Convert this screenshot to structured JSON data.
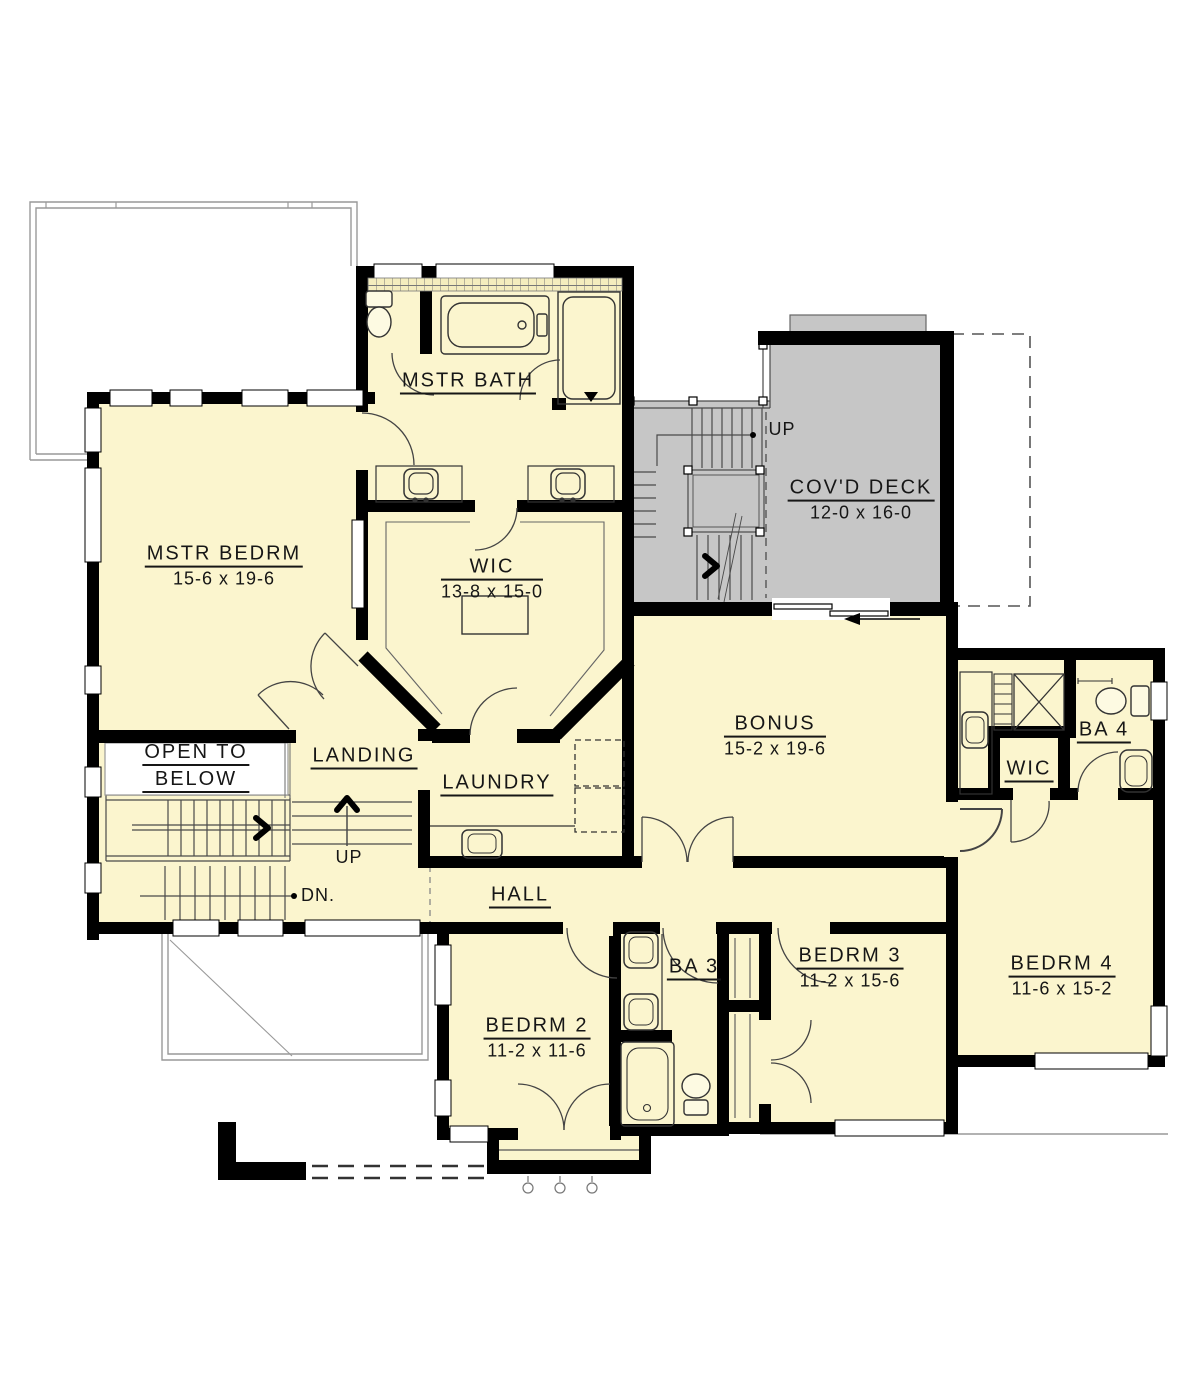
{
  "colors": {
    "floor": "#FBF5CE",
    "deck": "#C6C6C6",
    "wall": "#000000",
    "line": "#4a4a4a"
  },
  "labels": {
    "mstr_bath": {
      "name": "MSTR BATH"
    },
    "mstr_bedrm": {
      "name": "MSTR BEDRM",
      "dims": "15-6 x 19-6"
    },
    "wic_master": {
      "name": "WIC",
      "dims": "13-8 x 15-0"
    },
    "covd_deck": {
      "name": "COV'D DECK",
      "dims": "12-0 x 16-0"
    },
    "bonus": {
      "name": "BONUS",
      "dims": "15-2 x 19-6"
    },
    "ba4": {
      "name": "BA 4"
    },
    "wic_bedrm4": {
      "name": "WIC"
    },
    "open_below": {
      "line1": "OPEN TO",
      "line2": "BELOW"
    },
    "landing": {
      "name": "LANDING"
    },
    "laundry": {
      "name": "LAUNDRY"
    },
    "hall": {
      "name": "HALL"
    },
    "bedrm2": {
      "name": "BEDRM 2",
      "dims": "11-2 x 11-6"
    },
    "ba3": {
      "name": "BA 3"
    },
    "bedrm3": {
      "name": "BEDRM 3",
      "dims": "11-2 x 15-6"
    },
    "bedrm4": {
      "name": "BEDRM 4",
      "dims": "11-6 x 15-2"
    },
    "up_deck": {
      "text": "UP"
    },
    "up_landing": {
      "text": "UP"
    },
    "down": {
      "text": "DN."
    }
  }
}
